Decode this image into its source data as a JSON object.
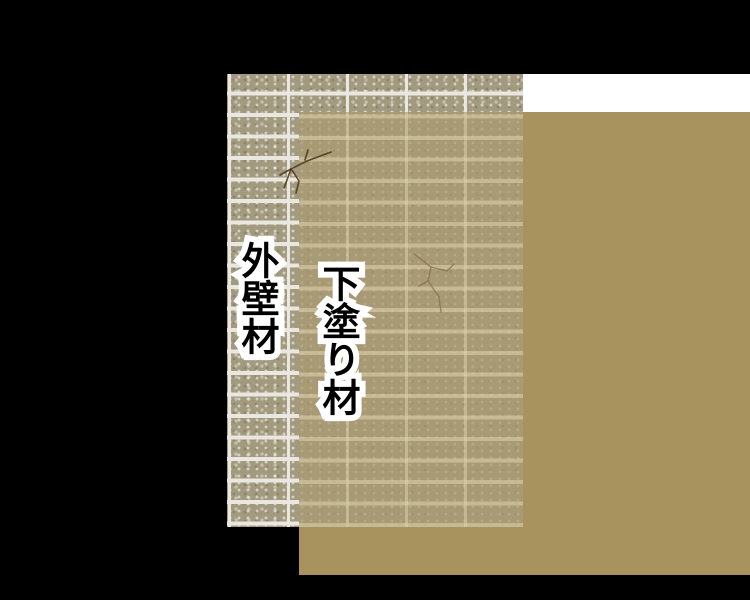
{
  "labels": {
    "exterior_wall": "外壁材",
    "undercoat": "下塗り材"
  },
  "colors": {
    "background": "#000000",
    "tile_base": "#a29a7f",
    "tile_grout": "#e9e7e0",
    "white_backdrop": "#ffffff",
    "undercoat_tan": "#a8925e",
    "undercoat_over_tile": "#a89a74",
    "crack_dark": "#4d3b1d",
    "crack_faint": "#87704a"
  }
}
